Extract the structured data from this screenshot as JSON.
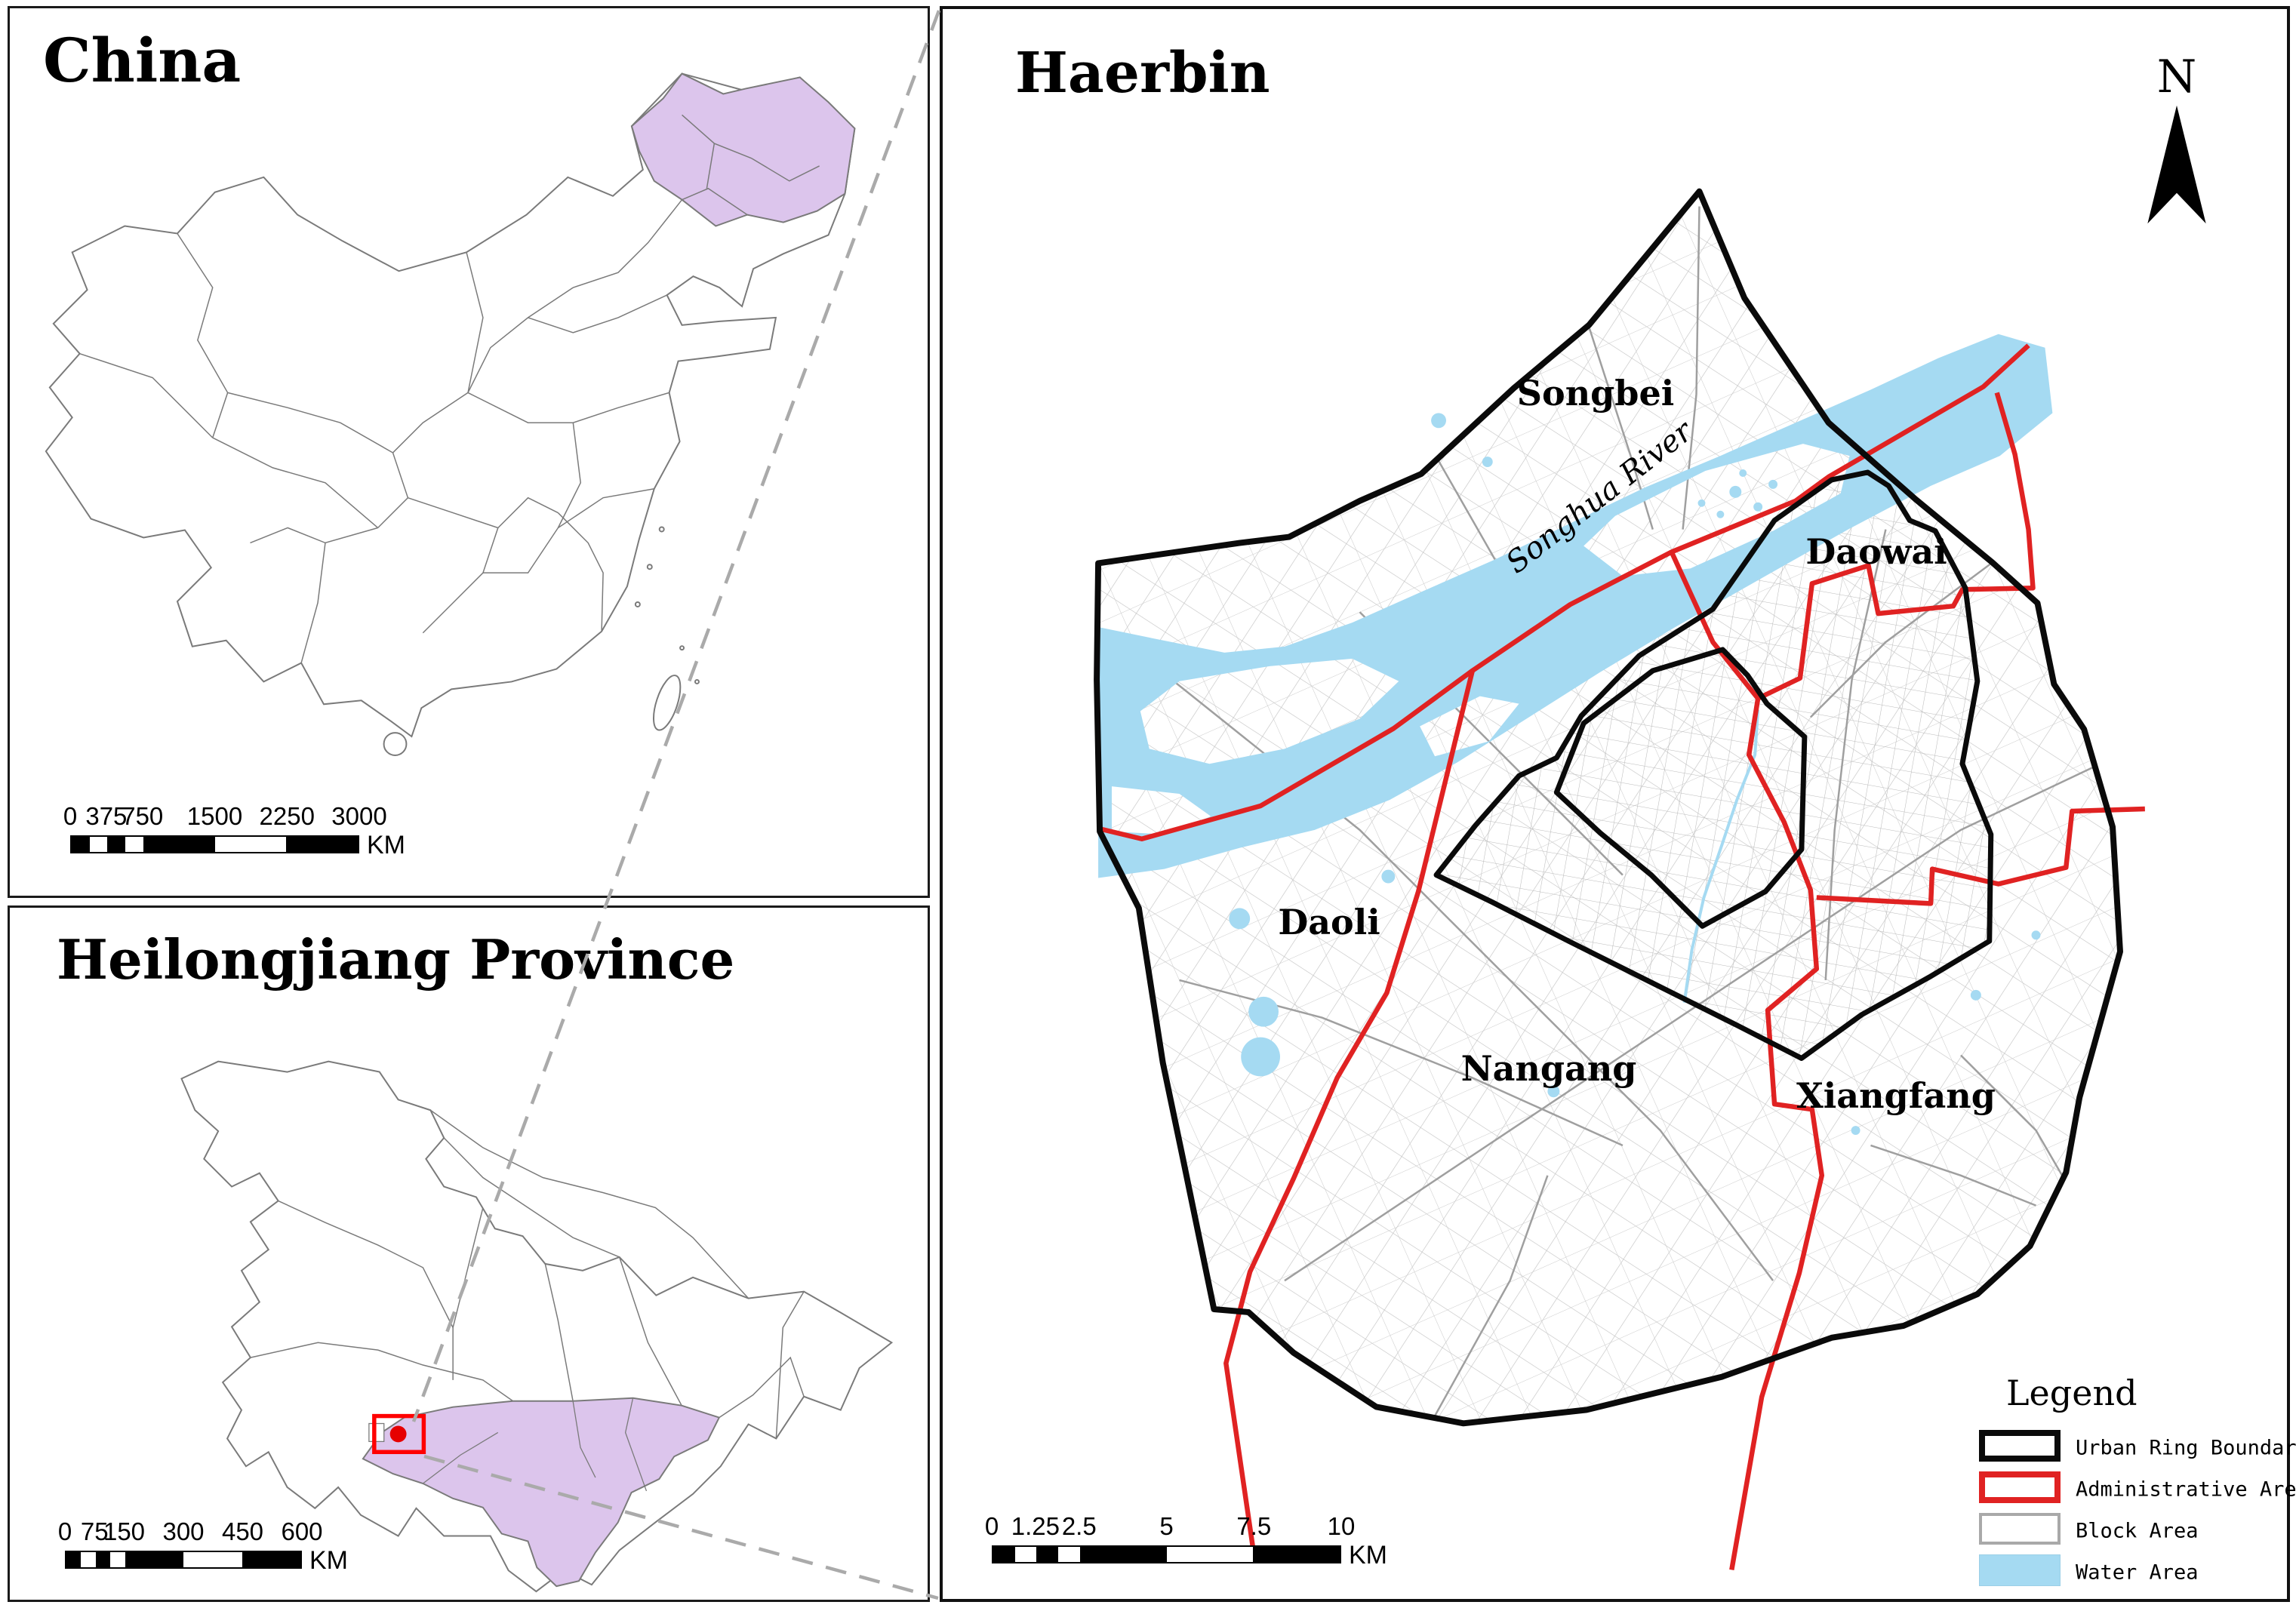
{
  "panels": {
    "china": {
      "title": "China"
    },
    "heilongjiang": {
      "title": "Heilongjiang Province"
    },
    "haerbin": {
      "title": "Haerbin"
    }
  },
  "north_arrow": {
    "label": "N"
  },
  "scalebars": {
    "china": {
      "ticks": [
        "0",
        "375",
        "750",
        "1500",
        "2250",
        "3000"
      ],
      "unit": "KM"
    },
    "heilongjiang": {
      "ticks": [
        "0",
        "75",
        "150",
        "300",
        "450",
        "600"
      ],
      "unit": "KM"
    },
    "haerbin": {
      "ticks": [
        "0",
        "1.25",
        "2.5",
        "5",
        "7.5",
        "10"
      ],
      "unit": "KM"
    }
  },
  "map_labels": {
    "songbei": "Songbei",
    "daowai": "Daowai",
    "daoli": "Daoli",
    "nangang": "Nangang",
    "xiangfang": "Xiangfang",
    "river": "Songhua River"
  },
  "legend": {
    "title": "Legend",
    "items": [
      {
        "label": "Urban Ring Boundary",
        "swatch": "black-outline"
      },
      {
        "label": "Administrative Area",
        "swatch": "red-outline"
      },
      {
        "label": "Block Area",
        "swatch": "gray-outline"
      },
      {
        "label": "Water Area",
        "swatch": "water-fill"
      }
    ]
  },
  "colors": {
    "water": "#A5DAF2",
    "highlight_purple": "#DCC5EC",
    "admin_red": "#E02222",
    "ring_black": "#0A0A0A",
    "block_gray": "#C3C3C3",
    "marker_red": "#FF0000",
    "province_outline_gray": "#7A7A7A"
  }
}
